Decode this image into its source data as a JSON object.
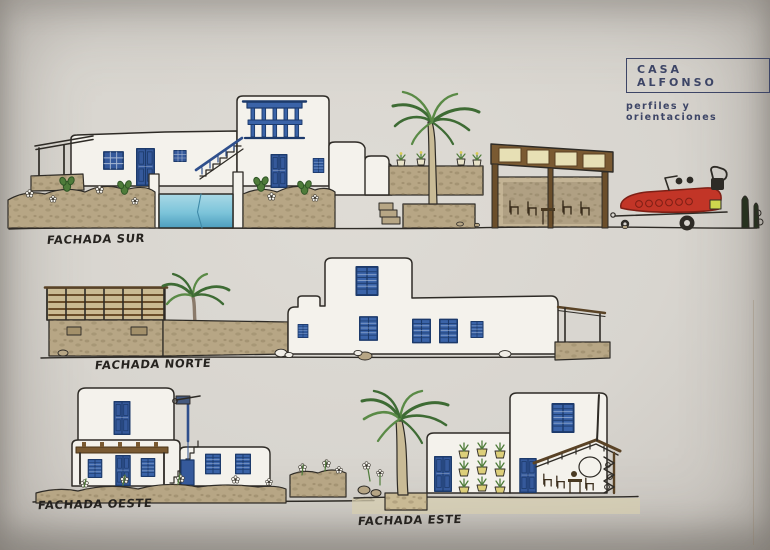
{
  "title_block": {
    "name": "CASA ALFONSO",
    "subtitle": "perfiles y orientaciones"
  },
  "facades": [
    {
      "id": "sur",
      "label": "FACHADA SUR"
    },
    {
      "id": "norte",
      "label": "FACHADA NORTE"
    },
    {
      "id": "oeste",
      "label": "FACHADA OESTE"
    },
    {
      "id": "este",
      "label": "FACHADA ESTE"
    }
  ],
  "colors": {
    "paper": "#d8d5cf",
    "ink": "#2e2b26",
    "title_navy": "#3d4566",
    "window_blue": "#3a63a8",
    "pool_blue": "#7cc4da",
    "stone_tan": "#b7a685",
    "palm_green": "#3e6b34",
    "wood_brown": "#7a5a32",
    "boat_red": "#c23527",
    "panel_cream": "#e7e0b5"
  }
}
